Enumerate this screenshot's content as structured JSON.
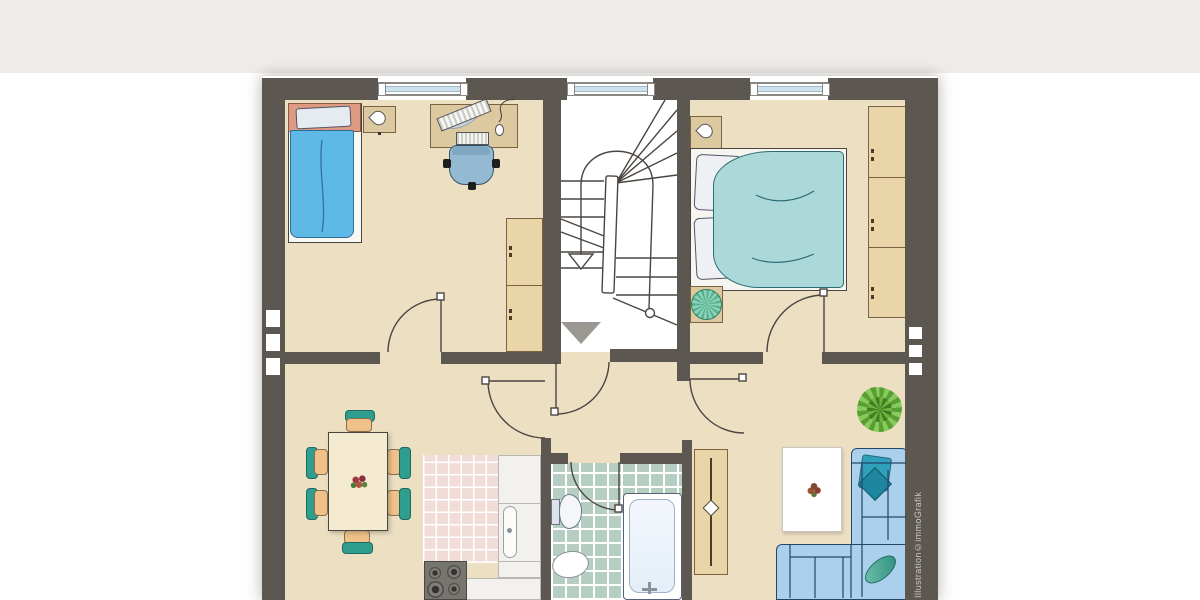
{
  "watermark": {
    "text": "Illustration©immoGrafik"
  },
  "colors": {
    "outside": "#ffffff",
    "outside_top": "#efedea",
    "wall": "#5d5752",
    "floor": "#ecdfc2",
    "stair": "#ffffff",
    "line": "#4a4540",
    "wood": "#e9d5a8",
    "wood2": "#dcc9a0",
    "wood_outline": "#7a6243",
    "kitchen_tile": "#f2dcd7",
    "bath_tile": "#b6cec1",
    "counter": "#f2f1ee",
    "counter_line": "#b9b7b2",
    "stove": "#77756f",
    "bed_blue": "#5fb9e6",
    "bed_blue_line": "#2e6e96",
    "headboard_salmon": "#dd9b82",
    "duvet_teal": "#abd8d8",
    "duvet_teal_line": "#2c6d74",
    "accent_teal": "#2f9e8f",
    "chair_wood": "#f0c189",
    "table_cream": "#f3ead0",
    "sofa": "#abd0ec",
    "sofa_line": "#27456b",
    "pillow_teal": "#2f9fba",
    "rug": "#ffffff",
    "plant_dark": "#569f30",
    "plant_light": "#8ac95e",
    "plant_radial": "#58b294",
    "office_chair": "#93b9d3",
    "glass": "#cfe3ee",
    "arrow_gray": "#9b9793",
    "watermark": "#c9c6c0",
    "tub_inner": "#e4eef8"
  }
}
